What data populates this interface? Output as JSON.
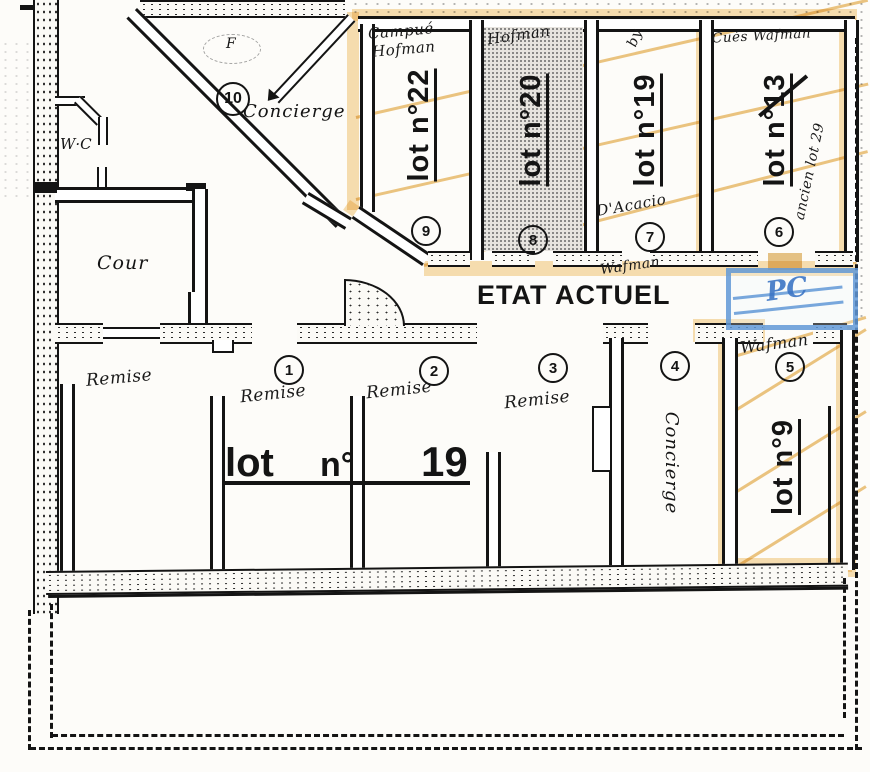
{
  "title": "ETAT ACTUEL",
  "rooms": {
    "wc": "W·C",
    "cour": "Cour",
    "concierge_top": "Concierge",
    "concierge_bottom": "Concierge",
    "door_letter": "F"
  },
  "big_lot": {
    "word": "lot",
    "no": "n°",
    "num": "19"
  },
  "top_cells": [
    {
      "circle": "9",
      "lot": "lot n°22",
      "note1": "Campué",
      "note2": "Hofman"
    },
    {
      "circle": "8",
      "lot": "lot n°20",
      "note1": "Hofman"
    },
    {
      "circle": "7",
      "lot": "lot n°19",
      "note1": "by"
    },
    {
      "circle": "6",
      "lot": "lot n°13",
      "note1": "Cués Wafman",
      "note_side": "ancien lot 29"
    }
  ],
  "annotations": {
    "near7": "D'Acacio",
    "under7": "Wafman",
    "near5": "Wafman",
    "pc": "PC"
  },
  "bottom": {
    "circles": [
      "1",
      "2",
      "3",
      "4",
      "5"
    ],
    "remise": [
      "Remise",
      "Remise",
      "Remise",
      "Remise"
    ],
    "lot9": "lot n°9",
    "circle10": "10"
  },
  "colors": {
    "orange": "#f0c473",
    "blue": "#5892d4",
    "ink": "#141414"
  }
}
